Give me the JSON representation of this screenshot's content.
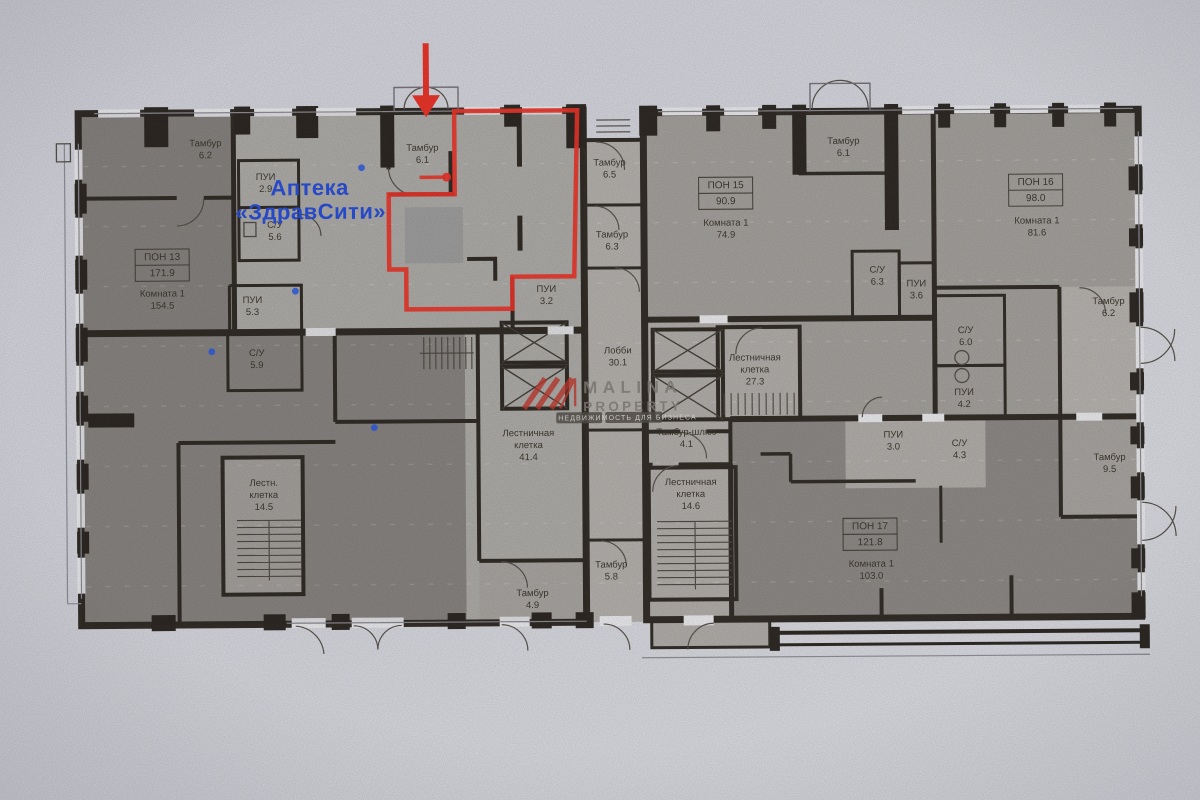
{
  "annotations": {
    "pharmacy": {
      "line1": "Аптека",
      "line2": "«ЗдравСити»",
      "color": "#2a4fd7"
    },
    "highlight_color": "#e8352a",
    "watermark": {
      "line1": "MALINA",
      "line2": "PROPERTY",
      "tagline": "НЕДВИЖИМОСТЬ ДЛЯ БИЗНЕСА",
      "logo_color": "#bf3a30"
    }
  },
  "rooms": [
    {
      "lines": [
        "Тамбур",
        "6.2"
      ],
      "x": 207,
      "y": 146
    },
    {
      "lines": [
        "ПОН 13",
        "171.9"
      ],
      "x": 163,
      "y": 262,
      "boxed": true
    },
    {
      "lines": [
        "Комната 1",
        "154.5"
      ],
      "x": 163,
      "y": 296
    },
    {
      "lines": [
        "ПУИ",
        "2.9"
      ],
      "x": 267,
      "y": 180
    },
    {
      "lines": [
        "С/У",
        "5.6"
      ],
      "x": 276,
      "y": 228
    },
    {
      "lines": [
        "ПУИ",
        "5.3"
      ],
      "x": 253,
      "y": 303
    },
    {
      "lines": [
        "С/У",
        "5.9"
      ],
      "x": 257,
      "y": 356
    },
    {
      "lines": [
        "Тамбур",
        "6.1"
      ],
      "x": 424,
      "y": 152
    },
    {
      "lines": [
        "ПУИ",
        "3.2"
      ],
      "x": 547,
      "y": 294
    },
    {
      "lines": [
        "Тамбур",
        "6.5"
      ],
      "x": 611,
      "y": 168
    },
    {
      "lines": [
        "Тамбур",
        "6.3"
      ],
      "x": 613,
      "y": 240
    },
    {
      "lines": [
        "Лобби",
        "30.1"
      ],
      "x": 618,
      "y": 356
    },
    {
      "lines": [
        "Лестничная",
        "клетка",
        "41.4"
      ],
      "x": 528,
      "y": 444
    },
    {
      "lines": [
        "Лестн.",
        "клетка",
        "14.5"
      ],
      "x": 263,
      "y": 492
    },
    {
      "lines": [
        "Тамбур",
        "4.9"
      ],
      "x": 531,
      "y": 598
    },
    {
      "lines": [
        "Тамбур",
        "5.8"
      ],
      "x": 610,
      "y": 570
    },
    {
      "lines": [
        "Тамбур-шлюз",
        "4.1"
      ],
      "x": 686,
      "y": 438
    },
    {
      "lines": [
        "Лестничная",
        "клетка",
        "14.6"
      ],
      "x": 690,
      "y": 494
    },
    {
      "lines": [
        "Лестничная",
        "клетка",
        "27.3"
      ],
      "x": 755,
      "y": 370
    },
    {
      "lines": [
        "Тамбур",
        "6.1"
      ],
      "x": 845,
      "y": 148
    },
    {
      "lines": [
        "ПОН 15",
        "90.9"
      ],
      "x": 727,
      "y": 194,
      "boxed": true
    },
    {
      "lines": [
        "Комната 1",
        "74.9"
      ],
      "x": 727,
      "y": 229
    },
    {
      "lines": [
        "С/У",
        "6.3"
      ],
      "x": 878,
      "y": 277
    },
    {
      "lines": [
        "ПУИ",
        "3.6"
      ],
      "x": 917,
      "y": 291
    },
    {
      "lines": [
        "ПОН 16",
        "98.0"
      ],
      "x": 1037,
      "y": 193,
      "boxed": true
    },
    {
      "lines": [
        "Комната 1",
        "81.6"
      ],
      "x": 1038,
      "y": 229
    },
    {
      "lines": [
        "Тамбур",
        "6.2"
      ],
      "x": 1109,
      "y": 310
    },
    {
      "lines": [
        "С/У",
        "6.0"
      ],
      "x": 966,
      "y": 338
    },
    {
      "lines": [
        "ПУИ",
        "4.2"
      ],
      "x": 964,
      "y": 400
    },
    {
      "lines": [
        "ПУИ",
        "3.0"
      ],
      "x": 893,
      "y": 442
    },
    {
      "lines": [
        "С/У",
        "4.3"
      ],
      "x": 959,
      "y": 451
    },
    {
      "lines": [
        "Тамбур",
        "9.5"
      ],
      "x": 1109,
      "y": 466
    },
    {
      "lines": [
        "ПОН 17",
        "121.8"
      ],
      "x": 869,
      "y": 536,
      "boxed": true
    },
    {
      "lines": [
        "Комната 1",
        "103.0"
      ],
      "x": 870,
      "y": 571
    }
  ]
}
